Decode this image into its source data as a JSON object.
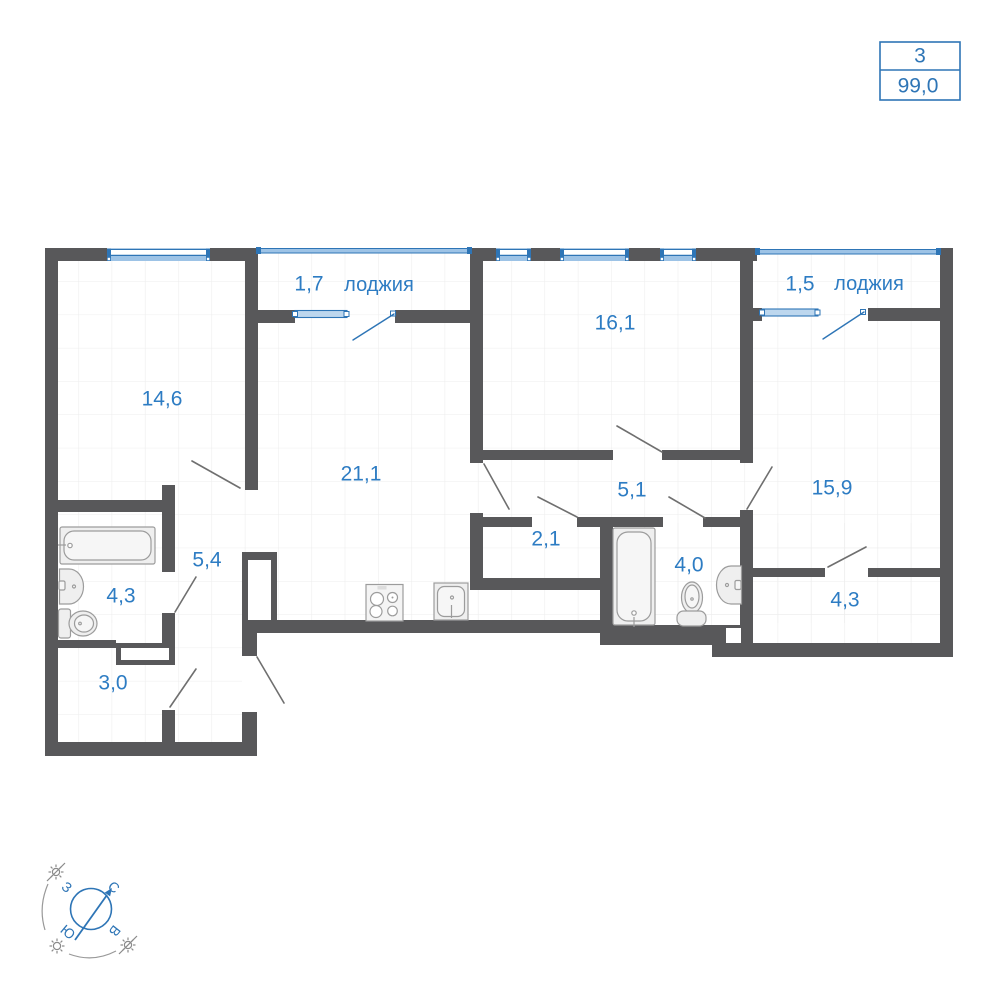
{
  "info_box": {
    "rooms": "3",
    "area": "99,0"
  },
  "rooms": [
    {
      "key": "room-14-6",
      "area": "14,6"
    },
    {
      "key": "loggia-west",
      "area": "1,7",
      "label": "лоджия"
    },
    {
      "key": "room-16-1",
      "area": "16,1"
    },
    {
      "key": "loggia-east",
      "area": "1,5",
      "label": "лоджия"
    },
    {
      "key": "kitchen-living-21-1",
      "area": "21,1"
    },
    {
      "key": "hall-5-1",
      "area": "5,1"
    },
    {
      "key": "storage-2-1",
      "area": "2,1"
    },
    {
      "key": "bathroom-4-0",
      "area": "4,0"
    },
    {
      "key": "room-15-9",
      "area": "15,9"
    },
    {
      "key": "wardrobe-4-3",
      "area": "4,3"
    },
    {
      "key": "hall-5-4",
      "area": "5,4"
    },
    {
      "key": "bathroom-4-3",
      "area": "4,3"
    },
    {
      "key": "storage-3-0",
      "area": "3,0"
    }
  ],
  "compass": {
    "north": "С",
    "east": "В",
    "south": "Ю",
    "west": "З"
  },
  "colors": {
    "wall": "#58585a",
    "accent_blue": "#2e75b6",
    "label_blue": "#2d7cc3",
    "window_fill": "#9dc3e6",
    "loggia_window_fill": "#bdd7ee",
    "fixture_fill": "#efefef",
    "fixture_stroke": "#9c9c9c",
    "grid": "#ededed",
    "door_swing": "#6f6f6f"
  }
}
